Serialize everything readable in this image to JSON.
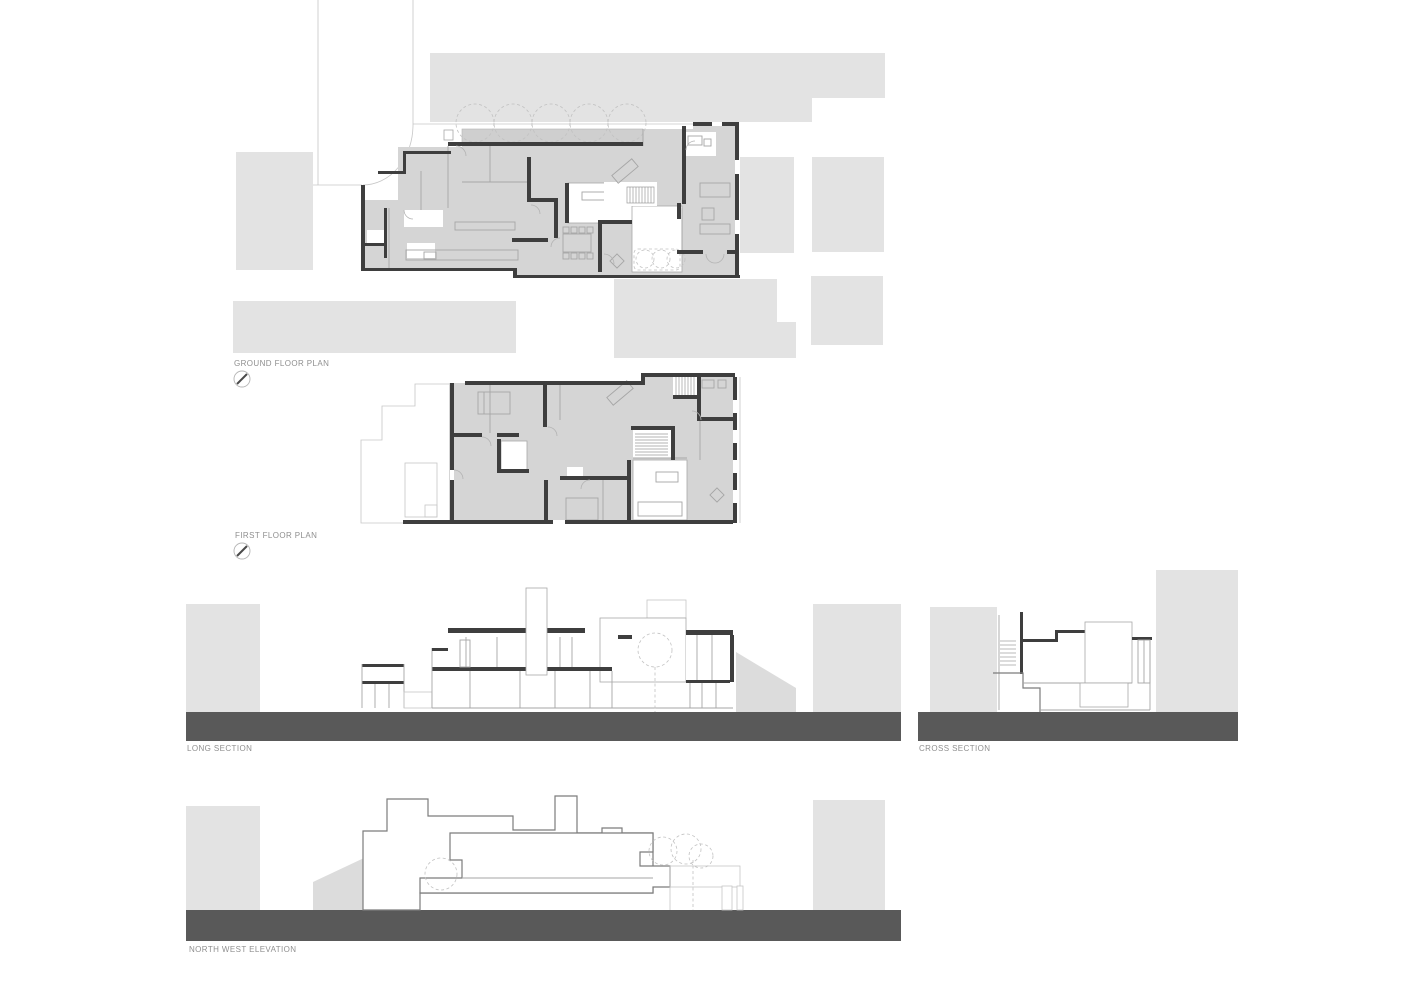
{
  "sheet": {
    "type": "architectural-drawing-sheet",
    "background": "#ffffff"
  },
  "labels": {
    "ground_floor_plan": "GROUND FLOOR PLAN",
    "first_floor_plan": "FIRST FLOOR PLAN",
    "long_section": "LONG SECTION",
    "cross_section": "CROSS SECTION",
    "north_west_elevation": "NORTH WEST ELEVATION"
  },
  "drawings": [
    {
      "id": "ground-floor-plan",
      "label": "GROUND FLOOR PLAN",
      "has_north_arrow": true
    },
    {
      "id": "first-floor-plan",
      "label": "FIRST FLOOR PLAN",
      "has_north_arrow": true
    },
    {
      "id": "long-section",
      "label": "LONG SECTION",
      "has_north_arrow": false
    },
    {
      "id": "cross-section",
      "label": "CROSS SECTION",
      "has_north_arrow": false
    },
    {
      "id": "north-west-elevation",
      "label": "NORTH WEST ELEVATION",
      "has_north_arrow": false
    }
  ],
  "icons": {
    "north_arrow": "circle with diagonal needle pointing north-east"
  },
  "colors": {
    "context_building_fill": "#e3e3e3",
    "plan_interior_fill": "#d5d5d5",
    "hedge_fill": "#cfcfcf",
    "wall_fill": "#3e3e3e",
    "ground_band_fill": "#595959",
    "shadow_fill": "#dcdcdc",
    "outline_line": "#a6a6a6",
    "dashed_line": "#c2c2c2",
    "label_text": "#8f8f8f"
  }
}
